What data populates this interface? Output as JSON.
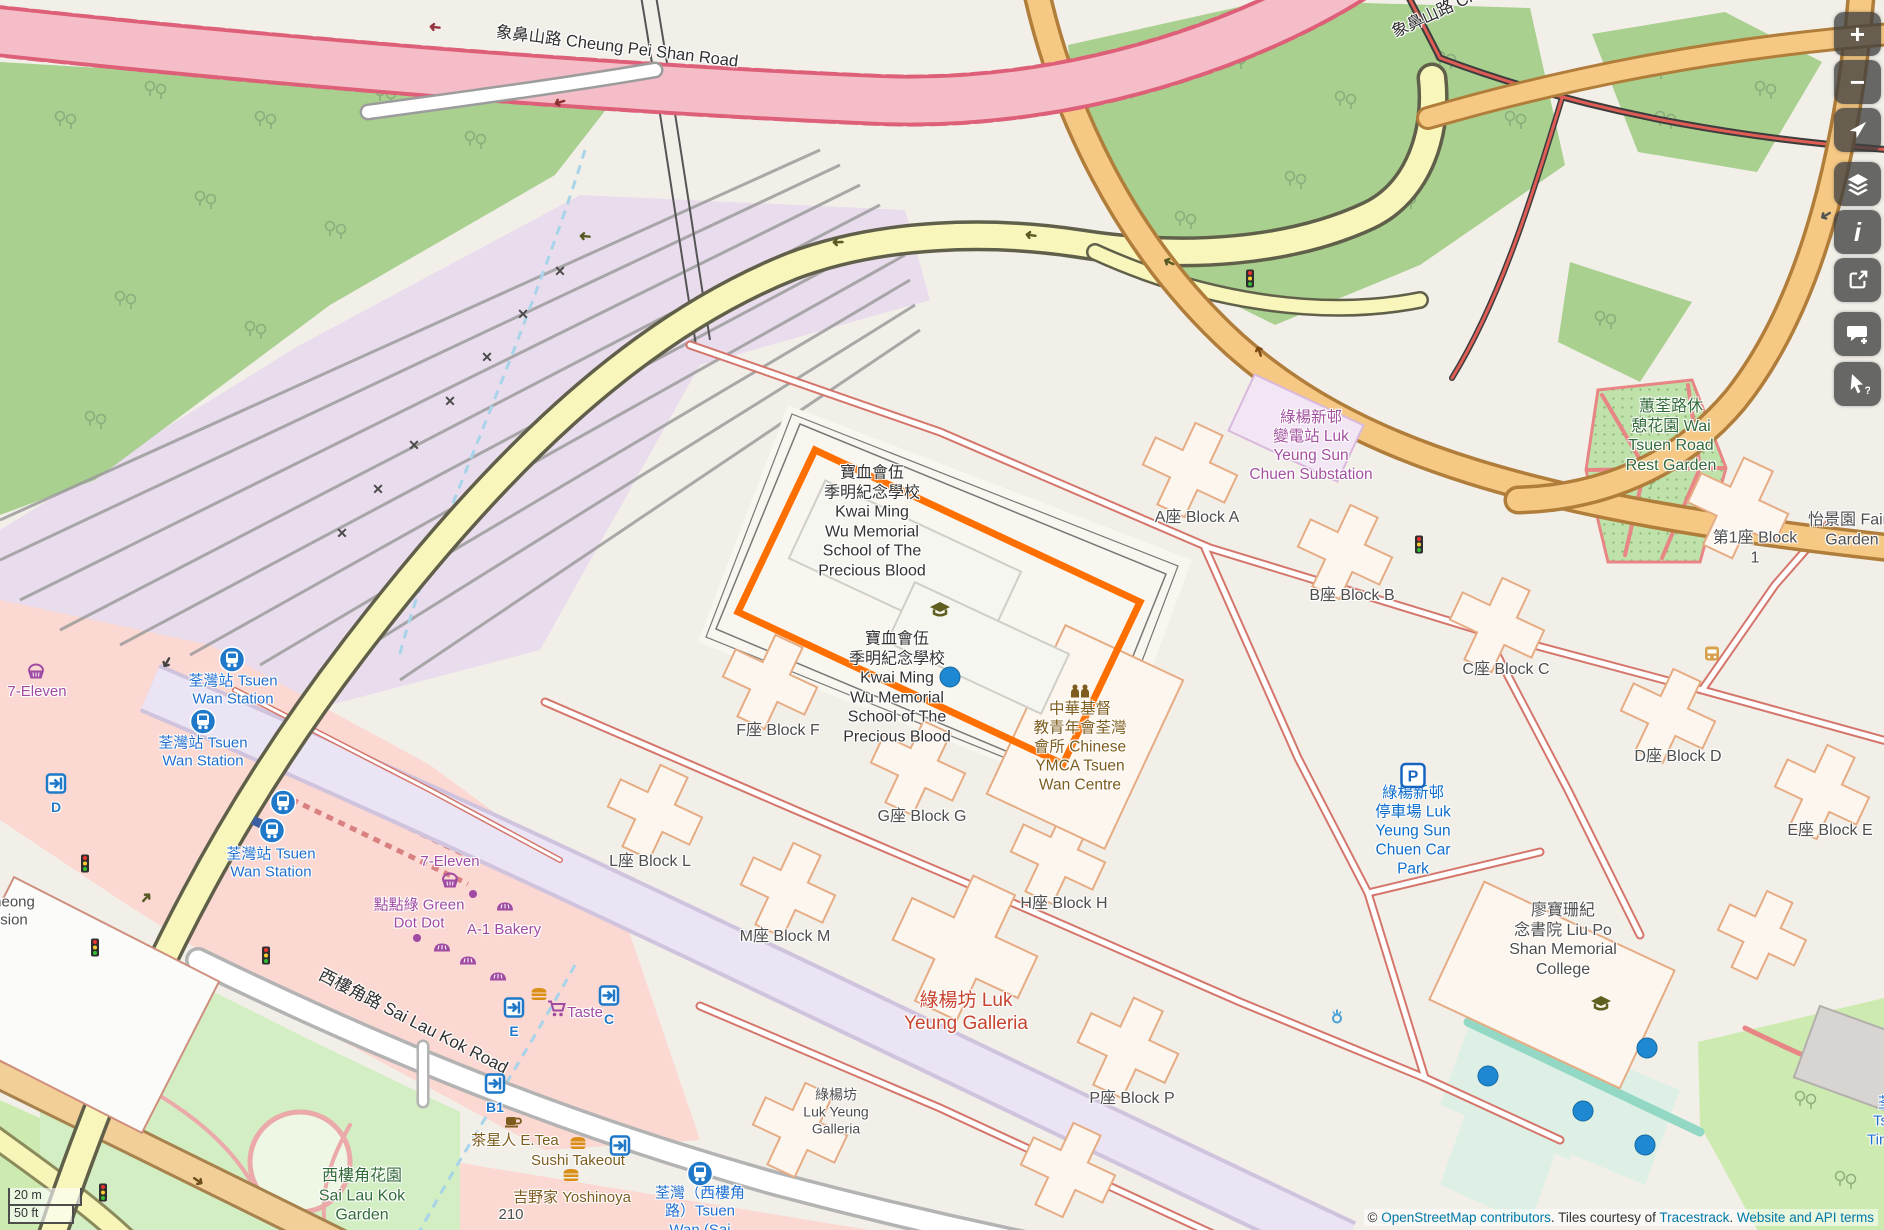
{
  "map": {
    "colors": {
      "selection_orange": "#ff6f00",
      "link_blue": "#0078a8",
      "transit_blue": "#1f6fd0",
      "shop_purple": "#a04ba3",
      "amenity_brown": "#7d5c1e",
      "park_green": "#336b3a",
      "mall_red": "#c7432e",
      "power_purple": "#a2519f",
      "parking_blue": "#0d6ecd"
    },
    "selected_feature": "寶血會伍季明紀念學校 Kwai Ming Wu Memorial School of The Precious Blood",
    "labels": [
      {
        "id": "cheung-pei-shan-road",
        "cls": "road",
        "x": 617,
        "y": 47,
        "rot": 7,
        "size": 16.5,
        "lines": [
          "象鼻山路 Cheung Pei Shan Road"
        ]
      },
      {
        "id": "cheung-pei-shan-road-2",
        "cls": "road",
        "x": 1447,
        "y": 8,
        "rot": -25,
        "size": 16.5,
        "lines": [
          "象鼻山路 Cheun"
        ]
      },
      {
        "id": "sai-lau-kok-road",
        "cls": "road",
        "x": 413,
        "y": 1022,
        "rot": 27,
        "size": 17,
        "lines": [
          "西樓角路 Sai Lau Kok Road"
        ]
      },
      {
        "id": "tsuen-wan-station-1",
        "cls": "transit",
        "x": 233,
        "y": 691,
        "lines": [
          "荃灣站 Tsuen",
          "Wan Station"
        ]
      },
      {
        "id": "tsuen-wan-station-2",
        "cls": "transit",
        "x": 203,
        "y": 753,
        "lines": [
          "荃灣站 Tsuen",
          "Wan Station"
        ]
      },
      {
        "id": "tsuen-wan-station-3",
        "cls": "transit",
        "x": 271,
        "y": 864,
        "lines": [
          "荃灣站 Tsuen",
          "Wan Station"
        ]
      },
      {
        "id": "tsuen-wan-slk-stop",
        "cls": "transit",
        "x": 700,
        "y": 1212,
        "lines": [
          "荃灣（西樓角",
          "路）Tsuen",
          "Wan (Sai"
        ]
      },
      {
        "id": "seven-eleven-west",
        "cls": "shop",
        "x": 37,
        "y": 692,
        "lines": [
          "7-Eleven"
        ]
      },
      {
        "id": "seven-eleven-mid",
        "cls": "shop",
        "x": 450,
        "y": 862,
        "lines": [
          "7-Eleven"
        ]
      },
      {
        "id": "green-dot-dot",
        "cls": "shop",
        "x": 419,
        "y": 915,
        "lines": [
          "點點綠 Green",
          "Dot Dot"
        ]
      },
      {
        "id": "a1-bakery",
        "cls": "shop",
        "x": 504,
        "y": 930,
        "lines": [
          "A-1 Bakery"
        ]
      },
      {
        "id": "taste",
        "cls": "shop",
        "x": 585,
        "y": 1013,
        "lines": [
          "Taste"
        ]
      },
      {
        "id": "e-tea",
        "cls": "food",
        "x": 515,
        "y": 1141,
        "lines": [
          "茶星人 E.Tea"
        ]
      },
      {
        "id": "sushi-takeout",
        "cls": "food",
        "x": 578,
        "y": 1161,
        "lines": [
          "Sushi Takeout"
        ]
      },
      {
        "id": "yoshinoya",
        "cls": "food",
        "x": 572,
        "y": 1198,
        "lines": [
          "吉野家 Yoshinoya"
        ]
      },
      {
        "id": "house-210",
        "cls": "block",
        "x": 511,
        "y": 1215,
        "size": 15,
        "lines": [
          "210"
        ]
      },
      {
        "id": "block-a",
        "cls": "block",
        "x": 1197,
        "y": 518,
        "lines": [
          "A座 Block A"
        ]
      },
      {
        "id": "block-b",
        "cls": "block",
        "x": 1352,
        "y": 596,
        "lines": [
          "B座 Block B"
        ]
      },
      {
        "id": "block-c",
        "cls": "block",
        "x": 1506,
        "y": 670,
        "lines": [
          "C座 Block C"
        ]
      },
      {
        "id": "block-d",
        "cls": "block",
        "x": 1678,
        "y": 757,
        "lines": [
          "D座 Block D"
        ]
      },
      {
        "id": "block-e",
        "cls": "block",
        "x": 1830,
        "y": 831,
        "lines": [
          "E座 Block E"
        ]
      },
      {
        "id": "block-f",
        "cls": "block",
        "x": 778,
        "y": 731,
        "lines": [
          "F座 Block F"
        ]
      },
      {
        "id": "block-g",
        "cls": "block",
        "x": 922,
        "y": 817,
        "lines": [
          "G座 Block G"
        ]
      },
      {
        "id": "block-h",
        "cls": "block",
        "x": 1064,
        "y": 904,
        "lines": [
          "H座 Block H"
        ]
      },
      {
        "id": "block-l",
        "cls": "block",
        "x": 650,
        "y": 862,
        "lines": [
          "L座 Block L"
        ]
      },
      {
        "id": "block-m",
        "cls": "block",
        "x": 785,
        "y": 937,
        "lines": [
          "M座 Block M"
        ]
      },
      {
        "id": "block-p",
        "cls": "block",
        "x": 1132,
        "y": 1099,
        "lines": [
          "P座 Block P"
        ]
      },
      {
        "id": "block-1",
        "cls": "block",
        "x": 1755,
        "y": 548,
        "lines": [
          "第1座 Block",
          "1"
        ]
      },
      {
        "id": "fairview-garden",
        "cls": "block",
        "x": 1852,
        "y": 530,
        "lines": [
          "怡景園 Fairv",
          "Garden"
        ]
      },
      {
        "id": "luk-yeung-galleria-small",
        "cls": "block",
        "x": 836,
        "y": 1112,
        "size": 14,
        "lines": [
          "綠楊坊",
          "Luk Yeung",
          "Galleria"
        ]
      },
      {
        "id": "liu-po-shan-college",
        "cls": "block",
        "x": 1563,
        "y": 940,
        "lines": [
          "廖寶珊紀",
          "念書院 Liu Po",
          "Shan Memorial",
          "College"
        ]
      },
      {
        "id": "cut-mansion",
        "cls": "block",
        "x": 14,
        "y": 912,
        "size": 15,
        "lines": [
          "heong",
          "sion"
        ]
      },
      {
        "id": "tin-hau",
        "cls": "transit",
        "x": 1893,
        "y": 1122,
        "lines": [
          "荃灣",
          "Tsuen",
          "Tin Hau"
        ]
      },
      {
        "id": "wai-tsuen-rest-garden",
        "cls": "park",
        "x": 1671,
        "y": 436,
        "lines": [
          "蕙荃路休",
          "憩花園 Wai",
          "Tsuen Road",
          "Rest Garden"
        ]
      },
      {
        "id": "sai-lau-kok-garden",
        "cls": "park",
        "x": 362,
        "y": 1196,
        "lines": [
          "西樓角花園",
          "Sai Lau Kok",
          "Garden"
        ]
      },
      {
        "id": "substation",
        "cls": "power",
        "x": 1311,
        "y": 447,
        "lines": [
          "綠楊新邨",
          "變電站 Luk",
          "Yeung Sun",
          "Chuen Substation"
        ]
      },
      {
        "id": "ymca",
        "cls": "food",
        "x": 1080,
        "y": 748,
        "size": 15.5,
        "lines": [
          "中華基督",
          "教青年會荃灣",
          "會所 Chinese",
          "YMCA Tsuen",
          "Wan Centre"
        ]
      },
      {
        "id": "car-park",
        "cls": "parking",
        "x": 1413,
        "y": 832,
        "lines": [
          "綠楊新邨",
          "停車場 Luk",
          "Yeung Sun",
          "Chuen Car",
          "Park"
        ]
      },
      {
        "id": "luk-yeung-galleria",
        "cls": "mall",
        "x": 966,
        "y": 1012,
        "lines": [
          "綠楊坊 Luk",
          "Yeung Galleria"
        ]
      },
      {
        "id": "school-label-top",
        "cls": "school",
        "x": 872,
        "y": 522,
        "lines": [
          "寶血會伍",
          "季明紀念學校",
          "Kwai Ming",
          "Wu Memorial",
          "School of The",
          "Precious Blood"
        ]
      },
      {
        "id": "school-label-mid",
        "cls": "school",
        "x": 897,
        "y": 688,
        "lines": [
          "寶血會伍",
          "季明紀念學校",
          "Kwai Ming",
          "Wu Memorial",
          "School of The",
          "Precious Blood"
        ]
      }
    ],
    "icons": [
      {
        "name": "railway-station-icon",
        "x": 232,
        "y": 662
      },
      {
        "name": "railway-station-icon",
        "x": 203,
        "y": 724
      },
      {
        "name": "railway-station-icon",
        "x": 283,
        "y": 805
      },
      {
        "name": "railway-station-icon",
        "x": 272,
        "y": 833
      },
      {
        "name": "railway-station-icon",
        "x": 700,
        "y": 1176
      },
      {
        "name": "station-square-icon",
        "x": 257,
        "y": 822
      },
      {
        "name": "entrance-icon",
        "letter": "E",
        "x": 514,
        "y": 1010
      },
      {
        "name": "entrance-icon",
        "letter": "C",
        "x": 609,
        "y": 998
      },
      {
        "name": "entrance-icon",
        "letter": "B1",
        "x": 495,
        "y": 1086
      },
      {
        "name": "entrance-icon",
        "letter": "D",
        "x": 56,
        "y": 786
      },
      {
        "name": "entrance-icon",
        "letter": "",
        "x": 620,
        "y": 1148
      },
      {
        "name": "basket-icon",
        "x": 36,
        "y": 674
      },
      {
        "name": "basket-icon",
        "x": 450,
        "y": 883
      },
      {
        "name": "bakery-icon",
        "x": 505,
        "y": 908
      },
      {
        "name": "bakery-icon",
        "x": 442,
        "y": 949
      },
      {
        "name": "bakery-icon",
        "x": 468,
        "y": 962
      },
      {
        "name": "bakery-icon",
        "x": 498,
        "y": 978
      },
      {
        "name": "shop-dot-icon",
        "x": 473,
        "y": 894
      },
      {
        "name": "shop-dot-icon",
        "x": 417,
        "y": 938
      },
      {
        "name": "cart-icon",
        "x": 556,
        "y": 1011
      },
      {
        "name": "burger-icon",
        "x": 539,
        "y": 996
      },
      {
        "name": "burger-icon",
        "x": 578,
        "y": 1145
      },
      {
        "name": "burger-icon",
        "x": 571,
        "y": 1177
      },
      {
        "name": "cup-icon",
        "x": 513,
        "y": 1124
      },
      {
        "name": "traffic-light-icon",
        "x": 266,
        "y": 958
      },
      {
        "name": "traffic-light-icon",
        "x": 85,
        "y": 866
      },
      {
        "name": "traffic-light-icon",
        "x": 95,
        "y": 950
      },
      {
        "name": "traffic-light-icon",
        "x": 103,
        "y": 1195
      },
      {
        "name": "traffic-light-icon",
        "x": 1250,
        "y": 281
      },
      {
        "name": "traffic-light-icon",
        "x": 1419,
        "y": 547
      },
      {
        "name": "pitch-dot-icon",
        "x": 950,
        "y": 677
      },
      {
        "name": "pitch-dot-icon",
        "x": 1647,
        "y": 1048
      },
      {
        "name": "pitch-dot-icon",
        "x": 1488,
        "y": 1076
      },
      {
        "name": "pitch-dot-icon",
        "x": 1583,
        "y": 1111
      },
      {
        "name": "pitch-dot-icon",
        "x": 1645,
        "y": 1145
      },
      {
        "name": "parking-icon",
        "x": 1413,
        "y": 778
      },
      {
        "name": "people-icon",
        "x": 1080,
        "y": 694
      },
      {
        "name": "school-icon",
        "x": 940,
        "y": 612
      },
      {
        "name": "school-icon",
        "x": 1601,
        "y": 1006
      },
      {
        "name": "fountain-icon",
        "x": 1337,
        "y": 1018
      },
      {
        "name": "bus-stop-icon",
        "x": 1712,
        "y": 656
      },
      {
        "name": "oneway-arrow-icon",
        "x": 435,
        "y": 28,
        "rot": 187,
        "color": "#93353f"
      },
      {
        "name": "oneway-arrow-icon",
        "x": 560,
        "y": 103,
        "rot": 163,
        "color": "#8a3030"
      },
      {
        "name": "oneway-arrow-icon",
        "x": 585,
        "y": 237,
        "rot": 185,
        "color": "#5a5a24"
      },
      {
        "name": "oneway-arrow-icon",
        "x": 838,
        "y": 243,
        "rot": 178,
        "color": "#5a5a24"
      },
      {
        "name": "oneway-arrow-icon",
        "x": 1031,
        "y": 236,
        "rot": 188,
        "color": "#5a5a24"
      },
      {
        "name": "oneway-arrow-icon",
        "x": 1169,
        "y": 263,
        "rot": 205,
        "color": "#5a5a24"
      },
      {
        "name": "oneway-arrow-icon",
        "x": 146,
        "y": 898,
        "rot": -48,
        "color": "#5a5a24"
      },
      {
        "name": "oneway-arrow-icon",
        "x": 198,
        "y": 1181,
        "rot": 35,
        "color": "#6b4e1c"
      },
      {
        "name": "oneway-arrow-icon",
        "x": 167,
        "y": 663,
        "rot": 120,
        "color": "#444444"
      },
      {
        "name": "oneway-arrow-icon",
        "x": 1259,
        "y": 352,
        "rot": 250,
        "color": "#7a4a12"
      },
      {
        "name": "oneway-arrow-icon",
        "x": 1826,
        "y": 216,
        "rot": 150,
        "color": "#555555"
      },
      {
        "name": "crossing-icon",
        "x": 560,
        "y": 272
      },
      {
        "name": "crossing-icon",
        "x": 523,
        "y": 315
      },
      {
        "name": "crossing-icon",
        "x": 487,
        "y": 358
      },
      {
        "name": "crossing-icon",
        "x": 450,
        "y": 402
      },
      {
        "name": "crossing-icon",
        "x": 414,
        "y": 446
      },
      {
        "name": "crossing-icon",
        "x": 378,
        "y": 490
      },
      {
        "name": "crossing-icon",
        "x": 342,
        "y": 534
      }
    ],
    "controls": [
      {
        "name": "zoom-in-button",
        "glyph": "+",
        "y": 12
      },
      {
        "name": "zoom-out-button",
        "glyph": "−",
        "y": 60
      },
      {
        "name": "locate-button",
        "icon": "navigation-arrow-icon",
        "y": 108
      },
      {
        "name": "layers-button",
        "icon": "layers-icon",
        "y": 162
      },
      {
        "name": "info-button",
        "glyph": "i",
        "y": 210
      },
      {
        "name": "share-button",
        "icon": "share-icon",
        "y": 258
      },
      {
        "name": "add-note-button",
        "icon": "note-icon",
        "y": 312
      },
      {
        "name": "query-features-button",
        "icon": "query-cursor-icon",
        "y": 362
      }
    ],
    "scale": {
      "metric": "20 m",
      "imperial": "50 ft"
    },
    "attribution": {
      "copyright": "© ",
      "osm_link": "OpenStreetMap contributors",
      "middle": ". Tiles courtesy of ",
      "tiles_link": "Tracestrack",
      "sep": ". ",
      "terms_link": "Website and API terms"
    }
  }
}
